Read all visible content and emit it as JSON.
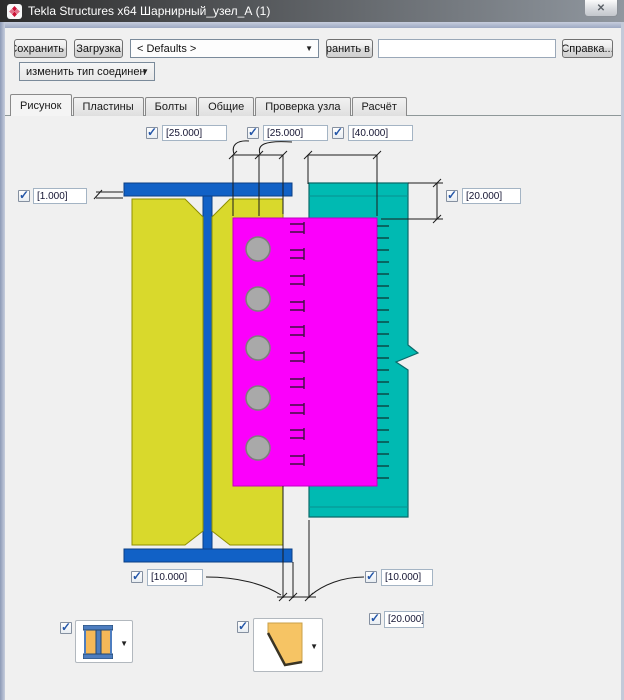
{
  "window": {
    "title": "Tekla Structures x64  Шарнирный_узел_А (1)"
  },
  "ui": {
    "check_glyph": "✓",
    "dropdown_glyph": "▼",
    "close_glyph": "✕"
  },
  "toolbar": {
    "save_label": "Сохранить",
    "load_label": "Загрузка",
    "defaults_value": "< Defaults >",
    "save_as_label": "Сохранить в",
    "name_value": "",
    "help_label": "Справка...",
    "change_type_label": "изменить тип соединен"
  },
  "tabs": [
    {
      "label": "Рисунок",
      "active": true
    },
    {
      "label": "Пластины",
      "active": false
    },
    {
      "label": "Болты",
      "active": false
    },
    {
      "label": "Общие",
      "active": false
    },
    {
      "label": "Проверка узла",
      "active": false
    },
    {
      "label": "Расчёт",
      "active": false
    }
  ],
  "fields": {
    "top_left": {
      "value": "[25.000]",
      "checked": true
    },
    "top_middle": {
      "value": "[25.000]",
      "checked": true
    },
    "top_right": {
      "value": "[40.000]",
      "checked": true
    },
    "left": {
      "value": "[1.000]",
      "checked": true
    },
    "right": {
      "value": "[20.000]",
      "checked": true
    },
    "bottom_left": {
      "value": "[10.000]",
      "checked": true
    },
    "bottom_right": {
      "value": "[10.000]",
      "checked": true
    },
    "bottom_far_right": {
      "value": "[20.000]",
      "checked": true
    }
  },
  "profile_selectors": [
    {
      "icon": "i-beam-section-icon",
      "checked": true
    },
    {
      "icon": "chamfered-plate-icon",
      "checked": true
    }
  ],
  "colors": {
    "beam_blue": "#1161c6",
    "plate_yellow": "#d9d92c",
    "beam_teal": "#00bab2",
    "plate_magenta": "#fb00fb",
    "bolt_gray": "#a9a9a9",
    "dim_line": "#1c1c1c",
    "titlebar_left": "#2c2c2c",
    "titlebar_right": "#90979f",
    "accent_check": "#2456a8"
  }
}
